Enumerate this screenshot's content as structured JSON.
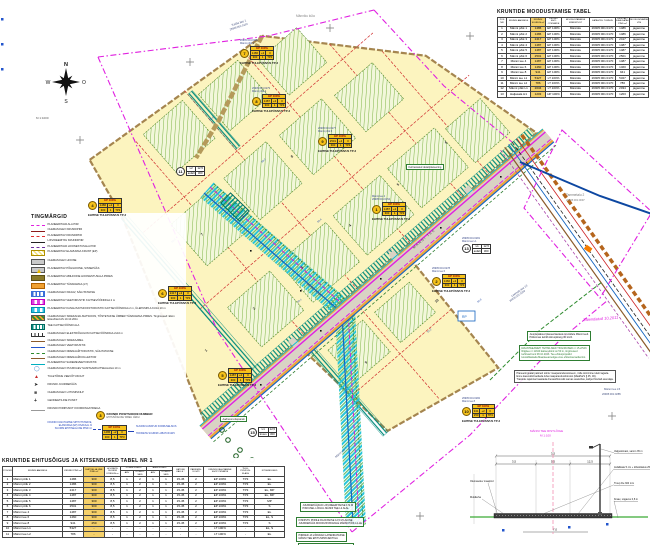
{
  "compass": {
    "n": "N",
    "w": "W",
    "o": "O",
    "s": "S"
  },
  "scale_note": "M 1:1000",
  "legend": {
    "title": "TINGMÄRGID",
    "items": [
      {
        "sw": "sw l-magdash",
        "label": "PLANEERITAVA ALA PIIR"
      },
      {
        "sw": "sw l-darkred",
        "label": "OLEMASOLEV KRUNDIPIIR"
      },
      {
        "sw": "sw l-reddash",
        "label": "PLANEERITAV KRUNDIPIIR"
      },
      {
        "sw": "sw l-black",
        "label": "LIKVIDEERITAV KRUNDIPIIR"
      },
      {
        "sw": "sw l-purpledash",
        "label": "PLANEERITAVA HOONESTUSALA PIIR"
      },
      {
        "sw": "sw b-yellowhatch",
        "label": "PLANEERITAV ELAMUMAA KRUNT (EP)"
      },
      {
        "sw": "sw b-gray",
        "label": "OLEMASOLEV HOONE"
      },
      {
        "sw": "sw b-graytri",
        "label": "PLANEERITAV PÕHIHOONE, SISSEPÄÄS"
      },
      {
        "sw": "sw b-olive",
        "label": "PLANEERITAV ABIHOONE HOONESTUSALA PIIRES"
      },
      {
        "sw": "sw b-orange",
        "label": "PLANEERITAV TÄNAVAMAA (LT)"
      },
      {
        "sw": "sw b-bluestripe",
        "label": "OLEMASOLEV KRAAV, SÄILITATAKSE"
      },
      {
        "sw": "sw b-magcheck",
        "label": "PLANEERITAV VEETORUSTIK KAITSEVÖÖNDIGA 2 m"
      },
      {
        "sw": "sw b-cyancheck",
        "label": "PLANEERITAV KANALISATSIOONITORUSTIK KAITSEVÖÖNDIGA 2 m, ÜLEPUMPLA KUJA 10 m"
      },
      {
        "sw": "sw b-orgreen",
        "label": "OLEMASOLEV SIDEKANALISATSIOON, TÕSTETAKSE ÜMBER TÄNAVAMAA PIIRES. Tingimused: Elion Ettevõtted AS 10.10.2011"
      },
      {
        "sw": "sw b-tealstripe",
        "label": "TEE KAITSEVÖÖNDI ALA"
      },
      {
        "sw": "sw l-tick",
        "label": "OLEMASOLEV ELEKTRIÕHULIIN KAITSEVÖÖNDIGA 2x10 m"
      },
      {
        "sw": "sw l-brown",
        "label": "OLEMASOLEV SIDEKAABEL"
      },
      {
        "sw": "sw l-blue",
        "label": "OLEMASOLEV VEETORUSTIK"
      },
      {
        "sw": "sw l-greendash",
        "label": "OLEMASOLEV DRENAAŽITORUSTIK, SÄILITATAKSE"
      },
      {
        "sw": "sw l-brown2",
        "label": "OLEMASOLEV DRENAAŽIKOLLEKTOR"
      },
      {
        "sw": "sw l-cyanline",
        "label": "PLANEERITAV SADEMEVEETORUSTIK"
      },
      {
        "sw": "sw g-circle",
        "label": "OLEMASOLEV PUURKAEV SANITAARKAITSEALAGA 10 m"
      },
      {
        "sw": "sw g-tri",
        "label": "TULETÕRJE VEEVÕTUKOHT"
      },
      {
        "sw": "sw g-arrow",
        "label": "KRUNDI JUURDEPÄÄS"
      },
      {
        "sw": "sw g-sq",
        "label": "OLEMASOLEV LIITUMISKILP"
      },
      {
        "sw": "sw g-plus",
        "label": "GEODEETILINE PUNKT"
      },
      {
        "sw": "sw l-dim",
        "label": "KRUNDI PIIRIPUNKT KOORDINAATIDEGA"
      }
    ]
  },
  "legend_sample": {
    "num": "3",
    "num_label1": "KRUNDI POSITSIOONI NUMBER",
    "num_label2": "EHITUSÕIGUSE TABELI JÄRGI",
    "left1": "KRUNDI KASUTAMISE SIHTOTSTARVE,",
    "left2": "ELAMUMAA (EP) OSAKAAL %",
    "left3": "SUURIM EHITISEALUNE PIND m²",
    "right1": "SUURIM LUBATUD KORRUSELISUS",
    "right2": "HOONETE SUURIM LUBATUD ARV",
    "box": {
      "h": "EP 100%",
      "c1": "1486",
      "c2": "+2",
      "c3": "II",
      "c4": "300",
      "c5": "1",
      "c6": "TP3"
    },
    "addr_label": "Aadressi ettepanek"
  },
  "table_a": {
    "title": "KRUNTIDE MOODUSTAMISE TABEL",
    "headers": [
      "POS NR",
      "KRUNDI AADRESS",
      "KRUNDI SUURUS m²",
      "KRUNDI SIHT- OTSTARVE",
      "MOODUSTATAKSE KINNISTUST",
      "KATASTRI- TUNNUS",
      "LIIDETAV / ERALDATAV PIND m²",
      "MOODUSTAMISE VIIS"
    ],
    "rows": [
      [
        "1",
        "Männi põik 1",
        "1486",
        "EP 100%",
        "Männiku",
        "26905:001:0170",
        "1486",
        "jagamine"
      ],
      [
        "2",
        "Männi põik 2",
        "1486",
        "EP 100%",
        "Männiku",
        "26905:001:0170",
        "1486",
        "jagamine"
      ],
      [
        "3",
        "Männi põik 3",
        "2417",
        "EP 100%",
        "Männiku",
        "26905:001:0170",
        "2417",
        "jagamine"
      ],
      [
        "4",
        "Männi põik 4",
        "1487",
        "EP 100%",
        "Männiku",
        "26905:001:0170",
        "1487",
        "jagamine"
      ],
      [
        "5",
        "Männi põik 5",
        "1487",
        "EP 100%",
        "Männiku",
        "26905:001:0170",
        "1487",
        "jagamine"
      ],
      [
        "6",
        "Männi põik 6",
        "2501",
        "EP 100%",
        "Männiku",
        "26905:001:0170",
        "2501",
        "jagamine"
      ],
      [
        "7",
        "Männi tee 4",
        "1487",
        "EP 100%",
        "Männiku",
        "26905:001:0170",
        "1487",
        "jagamine"
      ],
      [
        "8",
        "Männi tee 6",
        "1460",
        "EP 100%",
        "Männiku",
        "26905:001:0170",
        "1460",
        "jagamine"
      ],
      [
        "9",
        "Männi tee 8",
        "941",
        "EP 100%",
        "Männiku",
        "26905:001:0170",
        "941",
        "jagamine"
      ],
      [
        "10",
        "Männi tee L1",
        "5327",
        "LT 100%",
        "Männiku",
        "26905:001:0170",
        "5327",
        "jagamine"
      ],
      [
        "11",
        "Männi tee L2",
        "786",
        "LT 100%",
        "Männiku",
        "26905:001:0170",
        "786",
        "jagamine"
      ],
      [
        "12",
        "Männi põik L1",
        "2034",
        "LT 100%",
        "Männiku",
        "26905:001:0170",
        "2034",
        "jagamine"
      ],
      [
        "13",
        "Haljasala H1",
        "1203",
        "HP 100%",
        "Männiku",
        "26905:001:0170",
        "1203",
        "jagamine"
      ]
    ]
  },
  "table_b": {
    "title": "KRUNTIDE EHITUSÕIGUS JA KITSENDUSED TABEL NR 1",
    "h_pos": "POS NR",
    "h_addr": "KRUNDI AADRESS",
    "h_pind": "KRUNDI PIND m²",
    "h_ehit": "EHITISE- ALUNE PIND m²",
    "h_korg": "HOONETE SUURIM KÕRGUS m",
    "g_pohi": "PÕHIHOONEID",
    "g_abi": "ABIHOONEID",
    "h_arv": "ARV",
    "h_kor": "KORRU- SEID",
    "h_kalle": "KATUSE KALLE °",
    "h_park": "PARKIMIS- KOHTI",
    "h_siht": "KRUNDI KASUTAMISE SIHTOTSTARVE",
    "h_tp": "TULE- PÜSIVUS- KLASS",
    "h_kits": "KITSENDUSED",
    "rows": [
      [
        "1",
        "Männi põik 1",
        "1486",
        "300",
        "8,5",
        "1",
        "2",
        "1",
        "1",
        "15-45",
        "2",
        "EP 100%",
        "TP3",
        "EL"
      ],
      [
        "2",
        "Männi põik 2",
        "1486",
        "300",
        "8,5",
        "1",
        "2",
        "1",
        "1",
        "15-45",
        "2",
        "EP 100%",
        "TP3",
        "EL"
      ],
      [
        "3",
        "Männi põik 3",
        "2417",
        "300",
        "8,5",
        "1",
        "2",
        "1",
        "1",
        "15-45",
        "2",
        "EP 100%",
        "TP3",
        "EL, MP"
      ],
      [
        "4",
        "Männi põik 4",
        "1487",
        "300",
        "8,5",
        "1",
        "2",
        "1",
        "1",
        "15-45",
        "2",
        "EP 100%",
        "TP3",
        "EL, MP"
      ],
      [
        "5",
        "Männi põik 5",
        "1487",
        "300",
        "8,5",
        "1",
        "2",
        "1",
        "1",
        "15-45",
        "2",
        "EP 100%",
        "TP3",
        "MP"
      ],
      [
        "6",
        "Männi põik 6",
        "2501",
        "300",
        "8,5",
        "1",
        "2",
        "1",
        "1",
        "15-45",
        "2",
        "EP 100%",
        "TP3",
        "S"
      ],
      [
        "7",
        "Männi tee 4",
        "1487",
        "300",
        "8,5",
        "1",
        "2",
        "1",
        "1",
        "15-45",
        "2",
        "EP 100%",
        "TP3",
        "EL"
      ],
      [
        "8",
        "Männi tee 6",
        "1460",
        "300",
        "8,5",
        "1",
        "2",
        "1",
        "1",
        "15-45",
        "2",
        "EP 100%",
        "TP3",
        "EL, S"
      ],
      [
        "9",
        "Männi tee 8",
        "941",
        "250",
        "8,5",
        "1",
        "2",
        "1",
        "1",
        "15-45",
        "2",
        "EP 100%",
        "TP3",
        "S"
      ],
      [
        "10",
        "Männi tee L1",
        "5327",
        "-",
        "-",
        "-",
        "-",
        "-",
        "-",
        "-",
        "-",
        "LT 100%",
        "-",
        "EL, S"
      ],
      [
        "11",
        "Männi tee L2",
        "786",
        "-",
        "-",
        "-",
        "-",
        "-",
        "-",
        "-",
        "-",
        "LT 100%",
        "-",
        "EL"
      ]
    ]
  },
  "callouts": [
    {
      "num": "7",
      "t1": "26905:001:0281",
      "t2": "Männi põik 2",
      "h": "EP 100%",
      "c1": "1486",
      "c2": "+2",
      "c3": "II",
      "c4": "300",
      "c5": "1",
      "c6": "TP3",
      "cap": "EHITISE TULEPÜSIVUS TP-3"
    },
    {
      "num": "8",
      "t1": "26905:001:0279",
      "t2": "Männi põik 4",
      "h": "EP 100%",
      "c1": "1487",
      "c2": "+2",
      "c3": "II",
      "c4": "300",
      "c5": "1",
      "c6": "TP3",
      "cap": "EHITISE TULEPÜSIVUS TP-3"
    },
    {
      "num": "9",
      "t1": "26905:001:0277",
      "t2": "Männi põik 6",
      "h": "EP 100%",
      "c1": "2501",
      "c2": "+2",
      "c3": "II",
      "c4": "300",
      "c5": "1",
      "c6": "TP3",
      "cap": "EHITISE TULEPÜSIVUS TP-3"
    },
    {
      "num": "1",
      "t1": "Männi tee 4",
      "t2": "26905:001:0154",
      "h": "EP 100%",
      "c1": "1487",
      "c2": "+2",
      "c3": "II",
      "c4": "300",
      "c5": "1",
      "c6": "TP3",
      "cap": "EHITISE TULEPÜSIVUS TP-3"
    },
    {
      "num": "2",
      "t1": "26905:001:0278",
      "t2": "Männi tee 6",
      "h": "EP 100%",
      "c1": "1460",
      "c2": "+2",
      "c3": "II",
      "c4": "300",
      "c5": "1",
      "c6": "TP3",
      "cap": "EHITISE TULEPÜSIVUS TP-3"
    },
    {
      "num": "4",
      "t1": "",
      "t2": "",
      "h": "EP 100%",
      "c1": "1486",
      "c2": "+2",
      "c3": "II",
      "c4": "300",
      "c5": "1",
      "c6": "TP3",
      "cap": "EHITISE TULEPÜSIVUS TP-3"
    },
    {
      "num": "6",
      "t1": "",
      "t2": "",
      "h": "EP 100%",
      "c1": "2417",
      "c2": "+2",
      "c3": "II",
      "c4": "300",
      "c5": "1",
      "c6": "TP3",
      "cap": "EHITISE TULEPÜSIVUS TP-3"
    },
    {
      "num": "5",
      "t1": "",
      "t2": "",
      "h": "EP 100%",
      "c1": "1487",
      "c2": "+2",
      "c3": "II",
      "c4": "300",
      "c5": "1",
      "c6": "TP3",
      "cap": "EHITISE TULEPÜSIVUS TP-3"
    },
    {
      "num": "10",
      "t1": "26905:001:0282",
      "t2": "Männi tee 8",
      "h": "EP 100%",
      "c1": "941",
      "c2": "+2",
      "c3": "II",
      "c4": "250",
      "c5": "1",
      "c6": "TP3",
      "cap": "EHITISE TULEPÜSIVUS TP-3"
    },
    {
      "num": "11",
      "t1": "",
      "t2": "",
      "a": "L2",
      "b": "12,5",
      "c": "asfalt",
      "d": "300"
    },
    {
      "num": "13",
      "t1": "26905:001:0281",
      "t2": "Männi tee L1",
      "a": "L1",
      "b": "12,5",
      "c": "asfalt",
      "d": "300"
    },
    {
      "num": "15",
      "t1": "",
      "t2": "",
      "a": "L1",
      "b": "12,5",
      "c": "kruus",
      "d": "300"
    }
  ],
  "green_boxes": {
    "plan": "Kehtestatud detailplaneering",
    "addr": "Aadressi ettepanek",
    "rp": "RP"
  },
  "map_labels": {
    "l0": "Kalda tee 1",
    "l1": "26905:001:0153",
    "l2": "Männiku küla",
    "l3": "Tammetalu 2",
    "l4": "26905:001:0097",
    "l5": "Leetsalu tee 13",
    "l6": "26905:001:0283",
    "l7": "Männi tee L5",
    "l8": "26905:001:0285",
    "l9": "MÄNNI TEE",
    "l10": "MÄNNI PÕIK",
    "l11": "M 1:1000",
    "l12": "RP",
    "l13": "Männi tee 7"
  },
  "elev": [
    "58,6",
    "59,0",
    "58,4",
    "57,9",
    "57,2",
    "58,1",
    "59,3",
    "56,8"
  ],
  "plotnums": [
    "1",
    "2",
    "3",
    "4",
    "5",
    "6",
    "7",
    "8",
    "9",
    "10"
  ],
  "notes_bottom": [
    {
      "l1": "JUURDEPÄÄSUD LIKVIDEERITAKSE 172 M",
      "l2": "PIKKUSEL LÕIGUL MÄNNI TEE L2 ALAL"
    },
    {
      "l1": "KINNISTU PIIRILE RAJATAKSE 12,5 M LAIUNE",
      "l2": "JUURDEPÄÄS MOODUSTATAVALE MÄNNI PÕIK L2-LE"
    },
    {
      "l1": "PIIRDED JA VÄRAVAD LAHENDATAKSE",
      "l2": "MÄNNI TEE EHITUSPROJEKTIGA"
    },
    {
      "l1": "KÕNNITEE RAJATAKSE MÄNNI TEE ÄÄRDE",
      "l2": ""
    }
  ],
  "notes_right": {
    "box1": [
      "Juurdepääsud planeeritavatele kruntidele Männi teelt.",
      "Piirkonnas kehtib kiiruspiirang 30 km/h."
    ],
    "box2": [
      "MAANTEEAMETI TEHNILISED TINGIMUSED nr 15-2/543:",
      "Riigitee nr 11340 kaitsevöönd on 50 m, tingimused",
      "kehtivad kuni 08.10.2013. Tee-ehitusprojektid",
      "kooskõlastada Maanteeametiga enne ehitusloa taotlemist."
    ],
    "box3": [
      "Planeeringualal paikneb toimiv maaparandussüsteem, mille toimimine tuleb tagada.",
      "Enne kaevetöid taotleda luba maaparandusbüroost (MaaParS § 45, 46).",
      "Trasside rajamisel taastada drenaažitorustik samas asukohas, kahjud hüvitab arendaja."
    ],
    "script": "Täiendatud 10.2011"
  },
  "section": {
    "title1": "MÄNNI TEE RISTLÕIGE",
    "title2": "M 1:100",
    "dim1": "3,5",
    "dim2": "5,5",
    "dim3": "3,5",
    "total": "12,5",
    "depth": "7,0",
    "right0": "Valgustimast, samm 35 m",
    "right1": "Asfaltkate 5 cm + killustikalus 25 cm",
    "right2": "Truup De 300 mm",
    "right3": "Kraav, sügavus 0,8 m",
    "left0": "Olemasolev maapind",
    "left1": "Muldkeha"
  }
}
